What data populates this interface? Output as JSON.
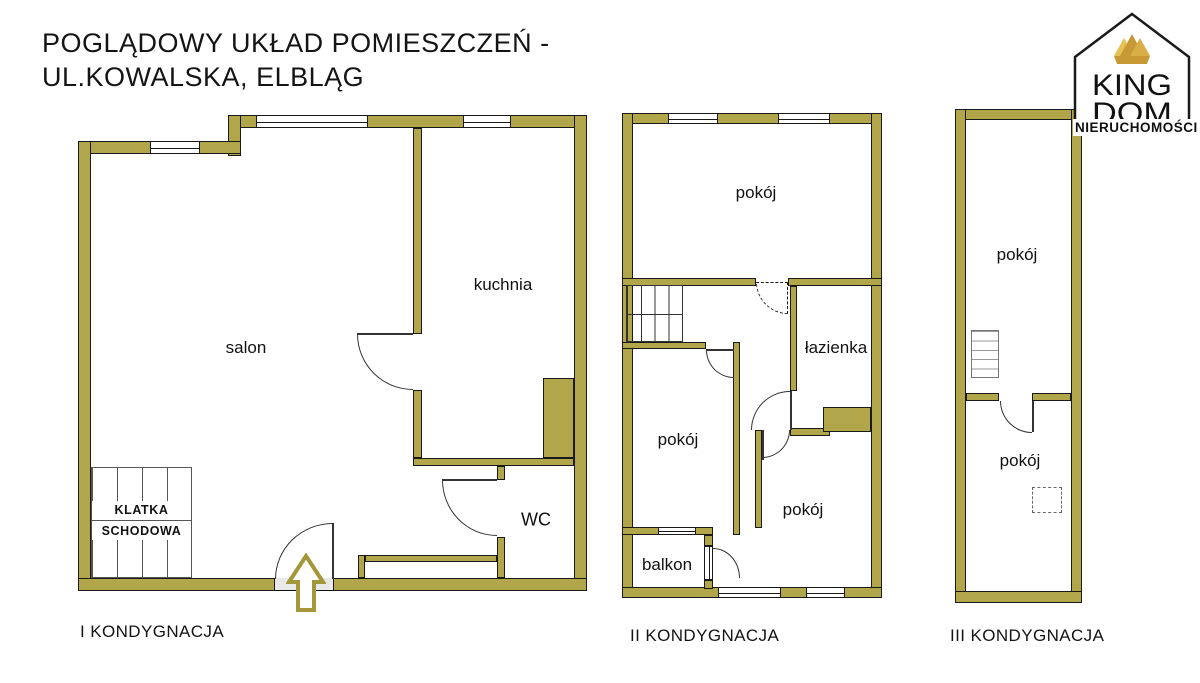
{
  "title": {
    "line1": "POGLĄDOWY UKŁAD POMIESZCZEŃ -",
    "line2": "UL.KOWALSKA, ELBLĄG"
  },
  "logo": {
    "king": "KING",
    "dom": "DOM",
    "subtitle": "NIERUCHOMOŚCI"
  },
  "icons": {
    "entrance_arrow": "up-arrow-entrance-marker",
    "logo_house": "house-outline",
    "logo_crown": "gold-crown"
  },
  "colors": {
    "wall": "#b1a64a",
    "wall_outline": "#1a1a1a",
    "arrow_gold": "#a3973a",
    "crown_light": "#e5c253",
    "crown_mid": "#d9ae45",
    "crown_dark": "#c89a35",
    "threshold_gray": "#e9e9e9"
  },
  "floors": [
    {
      "label": "I KONDYGNACJA",
      "rooms": {
        "salon": "salon",
        "kitchen": "kuchnia",
        "wc": "WC",
        "stair_line1": "KLATKA",
        "stair_line2": "SCHODOWA"
      }
    },
    {
      "label": "II KONDYGNACJA",
      "rooms": {
        "room_top": "pokój",
        "bathroom": "łazienka",
        "room_left": "pokój",
        "room_right": "pokój",
        "balcony": "balkon"
      }
    },
    {
      "label": "III KONDYGNACJA",
      "rooms": {
        "room_upper": "pokój",
        "room_lower": "pokój"
      }
    }
  ]
}
